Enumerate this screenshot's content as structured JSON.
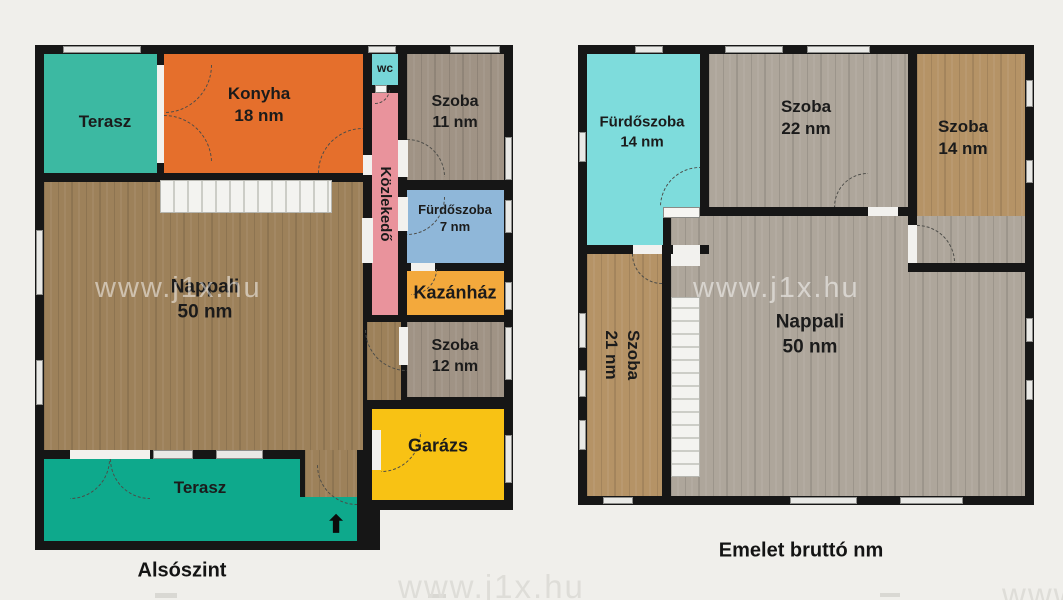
{
  "colors": {
    "background": "#f0efeb",
    "wall": "#161616",
    "terasz_top": "#3cb9a2",
    "konyha": "#e56f2c",
    "wc": "#76d6d7",
    "kozlekedo": "#e9939c",
    "szoba_gray": "#a89b8c",
    "furdoszoba7": "#8fb7d9",
    "kazanhaz": "#f3a93c",
    "nappali_brown": "#a5885f",
    "garazs": "#f8c214",
    "terasz_bottom": "#0ea98c",
    "furdoszoba14": "#7edcdc",
    "wood_lightgray": "#b7afa3",
    "wood_tan": "#bf9b6c"
  },
  "watermark": {
    "text": "www.j1x.hu"
  },
  "icons": {
    "entrance_arrow": "⬆"
  },
  "plans": {
    "lower": {
      "title": "Alsószint",
      "rooms": {
        "terasz_top": {
          "label": "Terasz"
        },
        "konyha": {
          "label": "Konyha",
          "area": "18 nm"
        },
        "wc": {
          "label": "wc"
        },
        "szoba11": {
          "label": "Szoba",
          "area": "11 nm"
        },
        "kozlekedo": {
          "label": "Közlekedő"
        },
        "furdoszoba7": {
          "label": "Fürdőszoba",
          "area": "7 nm"
        },
        "kazanhaz": {
          "label": "Kazánház"
        },
        "nappali": {
          "label": "Nappali",
          "area": "50 nm"
        },
        "szoba12": {
          "label": "Szoba",
          "area": "12 nm"
        },
        "garazs": {
          "label": "Garázs"
        },
        "terasz_bottom": {
          "label": "Terasz"
        }
      }
    },
    "upper": {
      "title": "Emelet bruttó nm",
      "rooms": {
        "furdoszoba14": {
          "label": "Fürdőszoba",
          "area": "14 nm"
        },
        "szoba22": {
          "label": "Szoba",
          "area": "22 nm"
        },
        "szoba14": {
          "label": "Szoba",
          "area": "14 nm"
        },
        "szoba21": {
          "label": "Szoba",
          "area": "21 nm"
        },
        "nappali50": {
          "label": "Nappali",
          "area": "50 nm"
        }
      }
    }
  }
}
